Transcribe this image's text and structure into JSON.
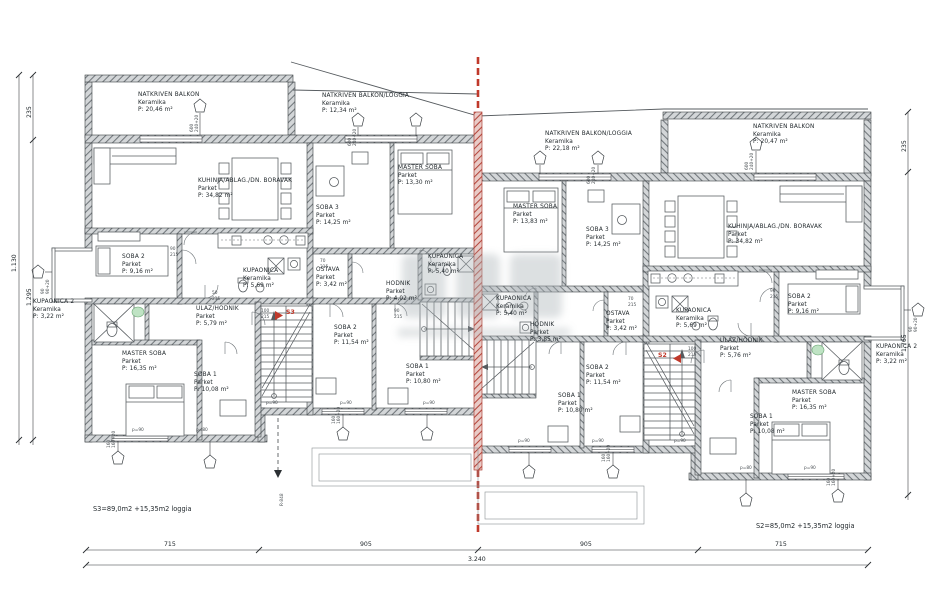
{
  "drawing": {
    "type": "floor-plan",
    "language": "hr",
    "colors": {
      "line": "#3c4145",
      "wall_fill": "#9aa0a4",
      "accent_red": "#c0392b",
      "fixture_green": "#bfe3c4"
    }
  },
  "left_unit": {
    "id": "S3",
    "stair_label": "S3",
    "summary": "S3=89,0m2 +15,35m2 loggia",
    "rooms": [
      {
        "name": "NATKRIVEN BALKON",
        "material": "Keramika",
        "area": "P: 20,46 m²"
      },
      {
        "name": "NATKRIVEN BALKON/LOGGIA",
        "material": "Keramika",
        "area": "P: 12,34 m²"
      },
      {
        "name": "KUHINJA/ABLAG./DN. BORAVAK",
        "material": "Parket",
        "area": "P: 34,82 m²"
      },
      {
        "name": "SOBA 3",
        "material": "Parket",
        "area": "P: 14,25 m²"
      },
      {
        "name": "MASTER SOBA",
        "material": "Parket",
        "area": "P: 13,30 m²"
      },
      {
        "name": "SOBA 2",
        "material": "Parket",
        "area": "P: 9,16 m²"
      },
      {
        "name": "KUPAONICA 2",
        "material": "Keramika",
        "area": "P: 3,22 m²"
      },
      {
        "name": "KUPAONICA",
        "material": "Keramika",
        "area": "P: 5,69 m²"
      },
      {
        "name": "ULAZ/HODNIK",
        "material": "Parket",
        "area": "P: 5,79 m²"
      },
      {
        "name": "MASTER SOBA",
        "material": "Parket",
        "area": "P: 16,35 m²"
      },
      {
        "name": "SOBA 1",
        "material": "Parket",
        "area": "P: 10,08 m²"
      },
      {
        "name": "OSTAVA",
        "material": "Parket",
        "area": "P: 3,42 m²"
      },
      {
        "name": "HODNIK",
        "material": "Parket",
        "area": "P: 4,02 m²"
      },
      {
        "name": "SOBA 2",
        "material": "Parket",
        "area": "P: 11,54 m²"
      },
      {
        "name": "SOBA 1",
        "material": "Parket",
        "area": "P: 10,80 m²"
      },
      {
        "name": "KUPAONICA",
        "material": "Keramika",
        "area": "P: 5,40 m²"
      }
    ]
  },
  "right_unit": {
    "id": "S2",
    "stair_label": "S2",
    "summary": "S2=85,0m2 +15,35m2 loggia",
    "rooms": [
      {
        "name": "NATKRIVEN BALKON/LOGGIA",
        "material": "Keramika",
        "area": "P: 22,18 m²"
      },
      {
        "name": "NATKRIVEN BALKON",
        "material": "Keramika",
        "area": "P: 20,47 m²"
      },
      {
        "name": "MASTER SOBA",
        "material": "Parket",
        "area": "P: 13,83 m²"
      },
      {
        "name": "SOBA 3",
        "material": "Parket",
        "area": "P: 14,25 m²"
      },
      {
        "name": "KUHINJA/ABLAG./DN. BORAVAK",
        "material": "Parket",
        "area": "P: 34,82 m²"
      },
      {
        "name": "SOBA 2",
        "material": "Parket",
        "area": "P: 9,16 m²"
      },
      {
        "name": "KUPAONICA 2",
        "material": "Keramika",
        "area": "P: 3,22 m²"
      },
      {
        "name": "KUPAONICA",
        "material": "Keramika",
        "area": "P: 5,69 m²"
      },
      {
        "name": "ULAZ/HODNIK",
        "material": "Parket",
        "area": "P: 5,76 m²"
      },
      {
        "name": "MASTER SOBA",
        "material": "Parket",
        "area": "P: 16,35 m²"
      },
      {
        "name": "SOBA 1",
        "material": "Parket",
        "area": "P: 10,08 m²"
      },
      {
        "name": "OSTAVA",
        "material": "Parket",
        "area": "P: 3,42 m²"
      },
      {
        "name": "HODNIK",
        "material": "Parket",
        "area": "P: 3,85 m²"
      },
      {
        "name": "SOBA 2",
        "material": "Parket",
        "area": "P: 11,54 m²"
      },
      {
        "name": "SOBA 1",
        "material": "Parket",
        "area": "P: 10,80 m²"
      },
      {
        "name": "KUPAONICA",
        "material": "Keramika",
        "area": "P: 5,40 m²"
      }
    ]
  },
  "dimensions": {
    "bottom_segments": [
      "715",
      "905",
      "905",
      "715"
    ],
    "bottom_total": "3.240",
    "left": [
      "235",
      "1.130",
      "1.295"
    ],
    "right": [
      "235",
      "1.765"
    ]
  },
  "tiny": {
    "w600": "600",
    "w240": "240+20",
    "w160": "160",
    "w160p": "160+20",
    "w90": "90",
    "w90p": "90+20",
    "d90": "90",
    "d80": "80",
    "d70": "70",
    "d100": "100",
    "d50": "50",
    "h215": "215",
    "p90": "p=90",
    "p80": "p=80",
    "section_mark": "R-848"
  }
}
